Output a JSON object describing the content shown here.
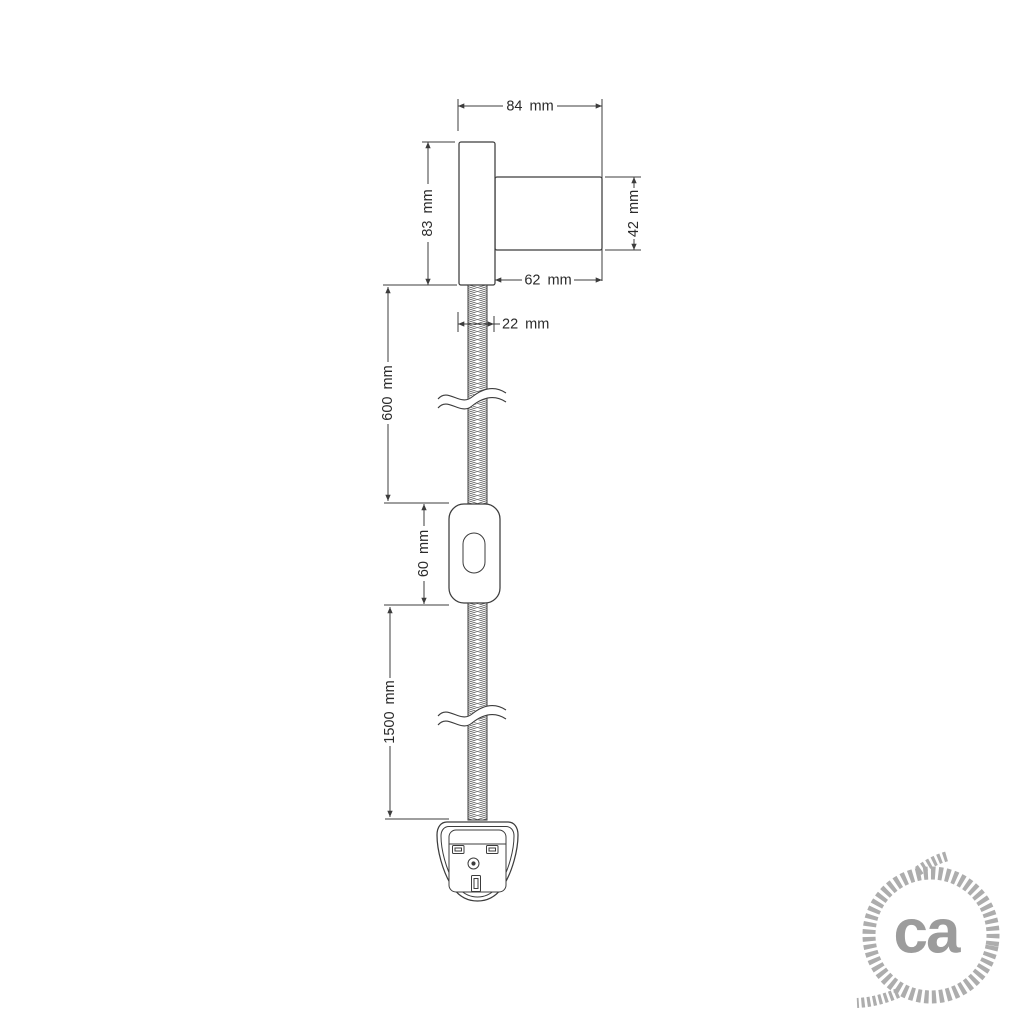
{
  "drawing": {
    "title": "wall lamp with braided cable, inline switch and plug - dimension drawing",
    "dimension_labels": {
      "overall_width": "84 mm",
      "base_height": "83 mm",
      "holder_diameter": "42 mm",
      "holder_length": "62 mm",
      "base_width": "22 mm",
      "cable_upper_length": "600 mm",
      "switch_height": "60 mm",
      "cable_lower_length": "1500 mm"
    }
  },
  "logo": {
    "text": "ca"
  },
  "colors": {
    "line": "#3c3c3c",
    "label_text": "#2a2a2a",
    "logo_rope": "#adadad",
    "logo_text": "#9c9c9c",
    "background": "#ffffff"
  }
}
